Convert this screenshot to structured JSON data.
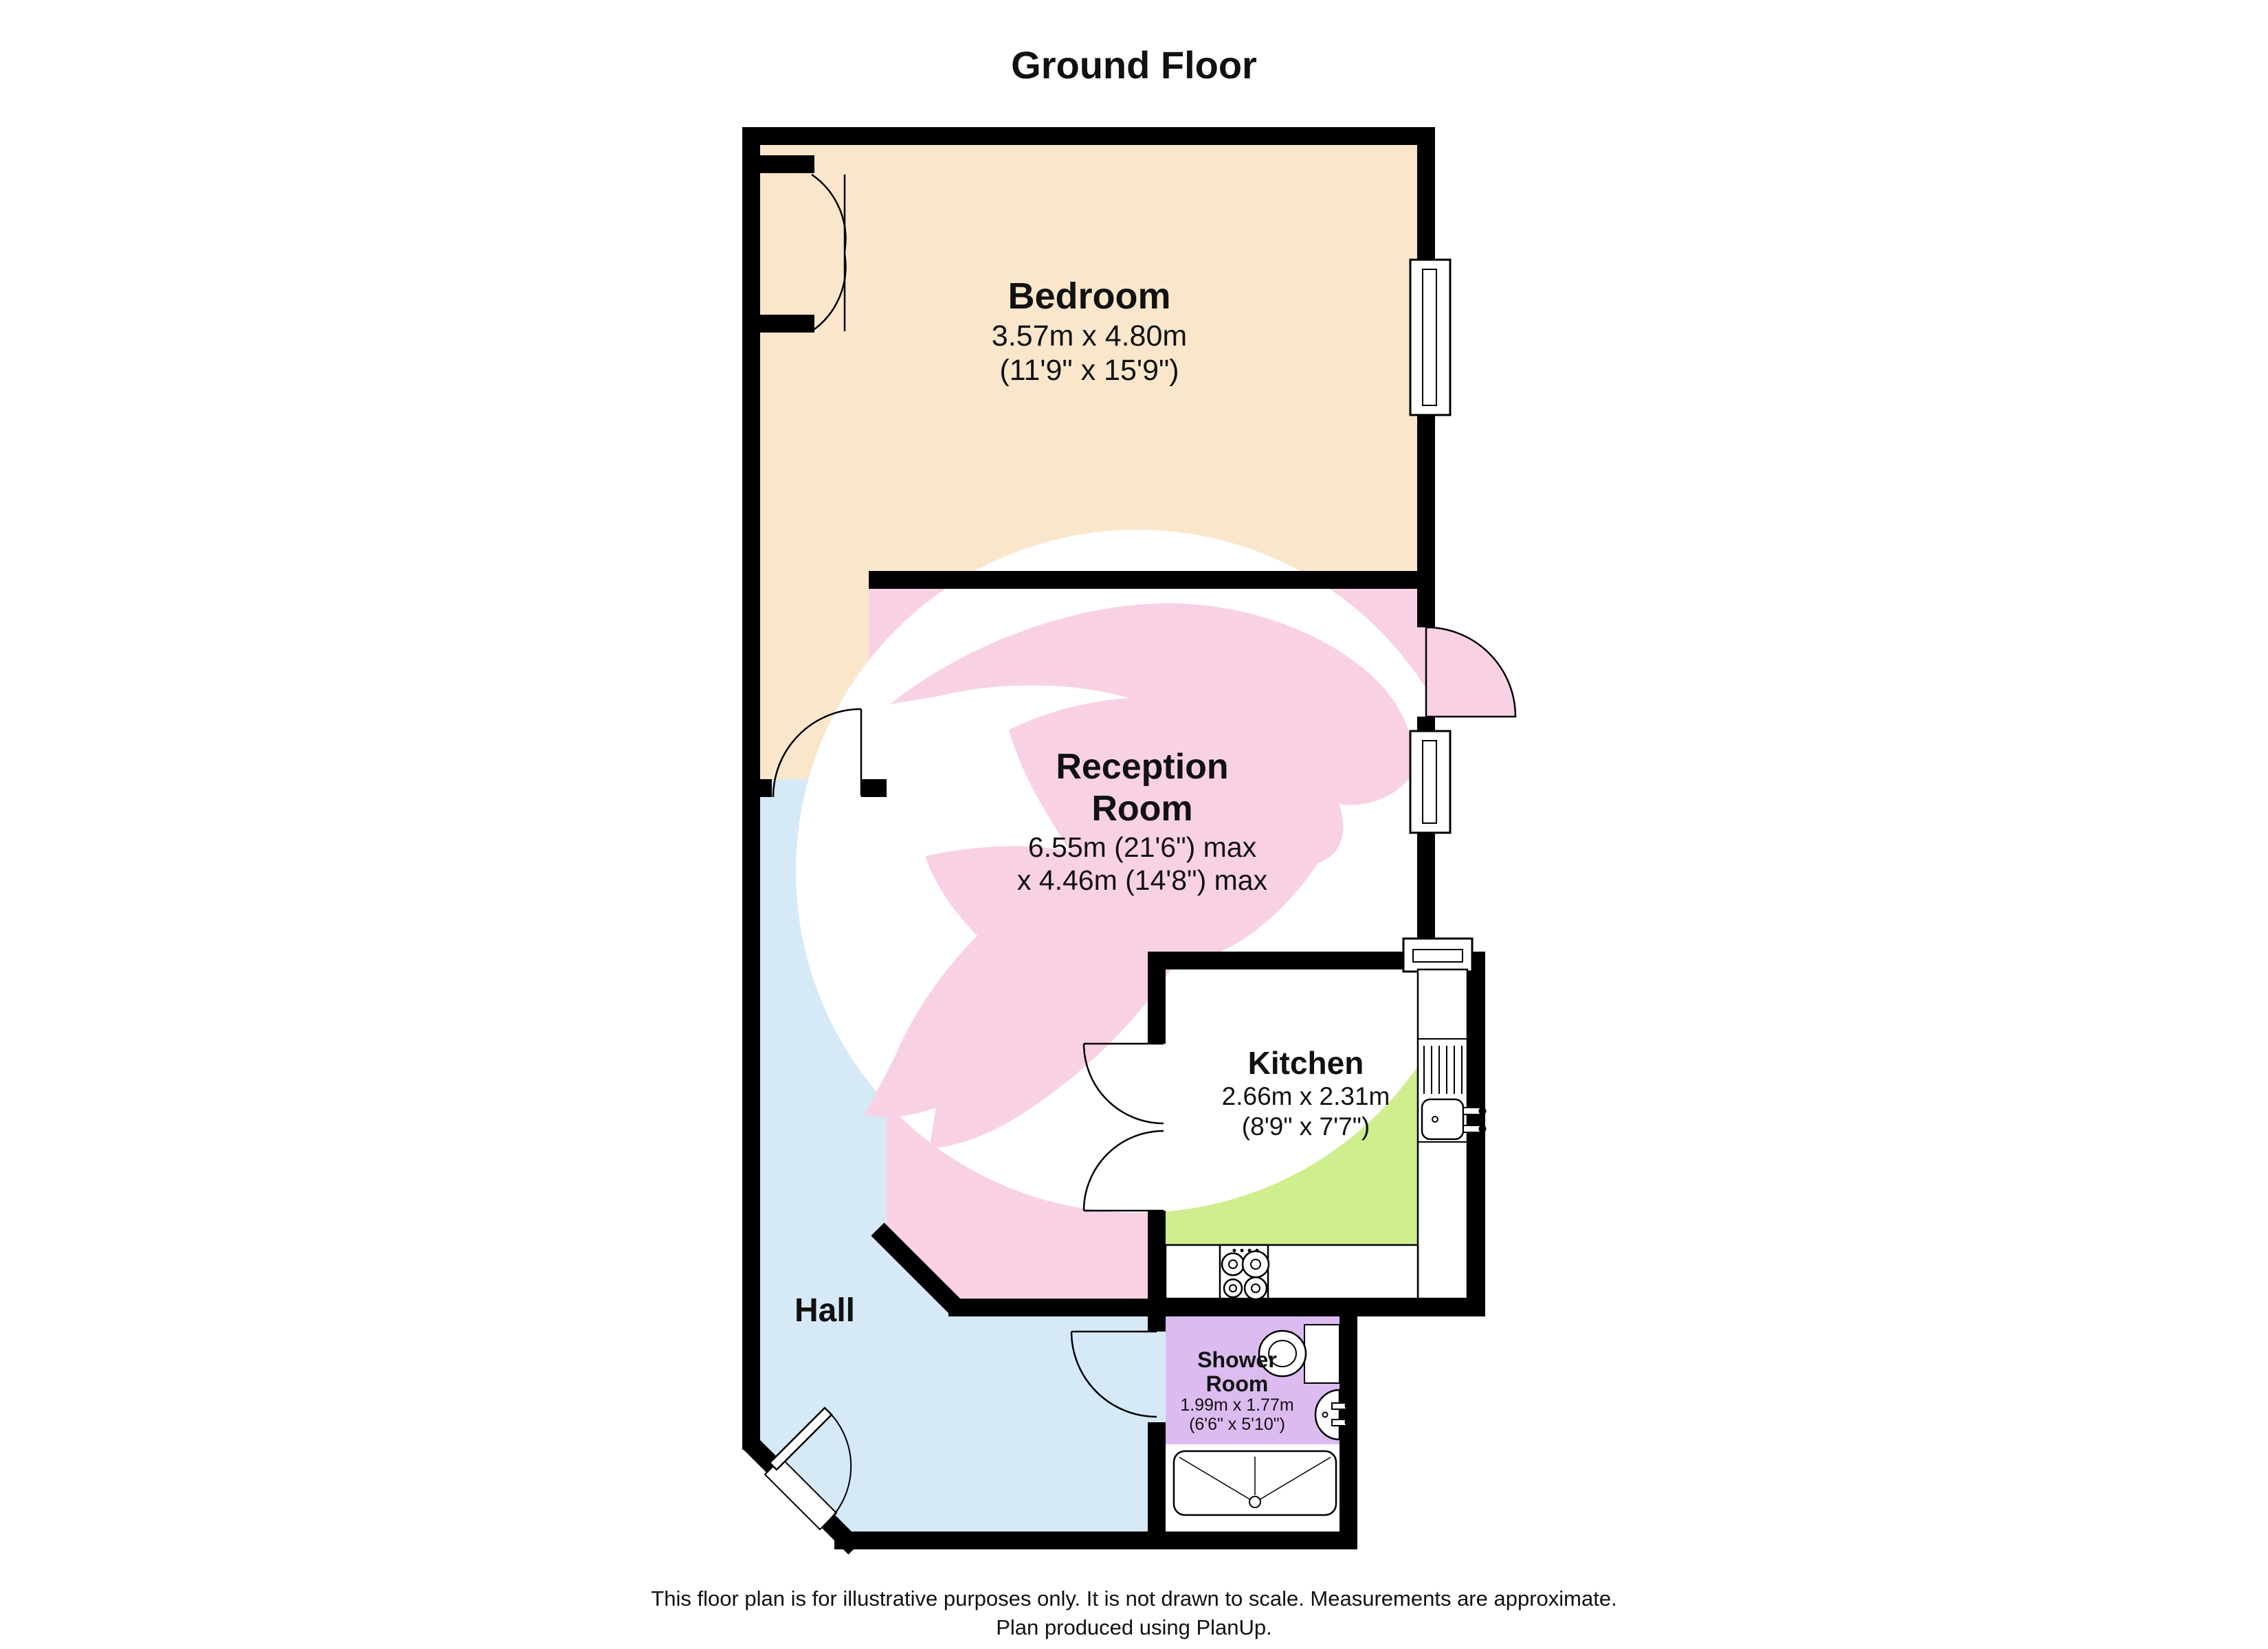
{
  "title": "Ground Floor",
  "rooms": {
    "bedroom": {
      "name": "Bedroom",
      "dimensions_metric": "3.57m x 4.80m",
      "dimensions_imperial": "(11'9\" x 15'9\")",
      "color": "#FAE7CB"
    },
    "reception": {
      "name_line1": "Reception",
      "name_line2": "Room",
      "dimensions_metric": "6.55m (21'6\") max",
      "dimensions_imperial": "x 4.46m (14'8\") max",
      "color": "#F9D1E5"
    },
    "kitchen": {
      "name": "Kitchen",
      "dimensions_metric": "2.66m x 2.31m",
      "dimensions_imperial": "(8'9\" x 7'7\")",
      "color": "#CFEE8E"
    },
    "shower_room": {
      "name_line1": "Shower",
      "name_line2": "Room",
      "dimensions_metric": "1.99m x 1.77m",
      "dimensions_imperial": "(6'6\" x 5'10\")",
      "color": "#DCBCF0"
    },
    "hall": {
      "name": "Hall",
      "color": "#D6E9F7"
    }
  },
  "colors": {
    "wall": "#000000",
    "watermark_circle": "#FFFFFF",
    "fixture_outline": "#000000",
    "text": "#111111"
  },
  "footer": {
    "line1": "This floor plan is for illustrative purposes only. It is not drawn to scale. Measurements are approximate.",
    "line2": "Plan produced using PlanUp."
  }
}
